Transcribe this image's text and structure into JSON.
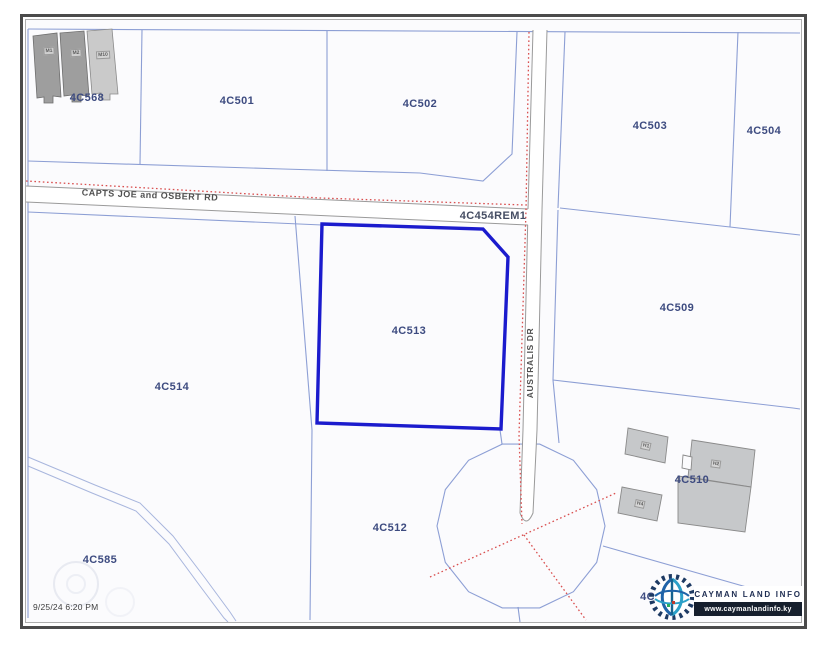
{
  "map": {
    "timestamp": "9/25/24 6:20 PM",
    "highlight_parcel": "4C513",
    "logo": {
      "title": "CAYMAN LAND INFO",
      "url": "www.caymanlandinfo.ky"
    },
    "road_labels": [
      {
        "name": "CAPTS JOE and OSBERT RD",
        "x": 150,
        "y": 195,
        "rot": 2.2,
        "cls": "road-label"
      },
      {
        "name": "AUSTRALIS DR",
        "x": 530,
        "y": 363,
        "rot": -90,
        "cls": "road-label small"
      }
    ],
    "parcel_labels": [
      {
        "id": "4C568",
        "x": 87,
        "y": 98
      },
      {
        "id": "4C501",
        "x": 237,
        "y": 101
      },
      {
        "id": "4C502",
        "x": 420,
        "y": 104
      },
      {
        "id": "4C503",
        "x": 650,
        "y": 126
      },
      {
        "id": "4C504",
        "x": 764,
        "y": 131
      },
      {
        "id": "4C454REM1",
        "x": 493,
        "y": 216,
        "dark": true
      },
      {
        "id": "4C509",
        "x": 677,
        "y": 308
      },
      {
        "id": "4C513",
        "x": 409,
        "y": 331
      },
      {
        "id": "4C514",
        "x": 172,
        "y": 387
      },
      {
        "id": "4C510",
        "x": 692,
        "y": 480
      },
      {
        "id": "4C512",
        "x": 390,
        "y": 528
      },
      {
        "id": "4C585",
        "x": 100,
        "y": 560
      },
      {
        "id": "4C511",
        "x": 657,
        "y": 597
      }
    ],
    "building_labels": [
      {
        "id": "M1",
        "x": 49,
        "y": 51,
        "rot": -3
      },
      {
        "id": "M2",
        "x": 76,
        "y": 53,
        "rot": -3
      },
      {
        "id": "M10",
        "x": 103,
        "y": 55,
        "rot": -3
      },
      {
        "id": "H1",
        "x": 646,
        "y": 446,
        "rot": 12
      },
      {
        "id": "H2",
        "x": 716,
        "y": 464,
        "rot": 8
      },
      {
        "id": "H4",
        "x": 640,
        "y": 504,
        "rot": 12
      }
    ],
    "colors": {
      "highlight": "#1b1bcd",
      "boundary": "#8195d0",
      "road_edge": "#9a9a9a",
      "red_tie": "#d94f4f",
      "parcel_label": "#3d4b80",
      "road_label": "#4f4f4f",
      "building_fill": "#c6c8ca",
      "frame": "#4b4b4b"
    }
  }
}
